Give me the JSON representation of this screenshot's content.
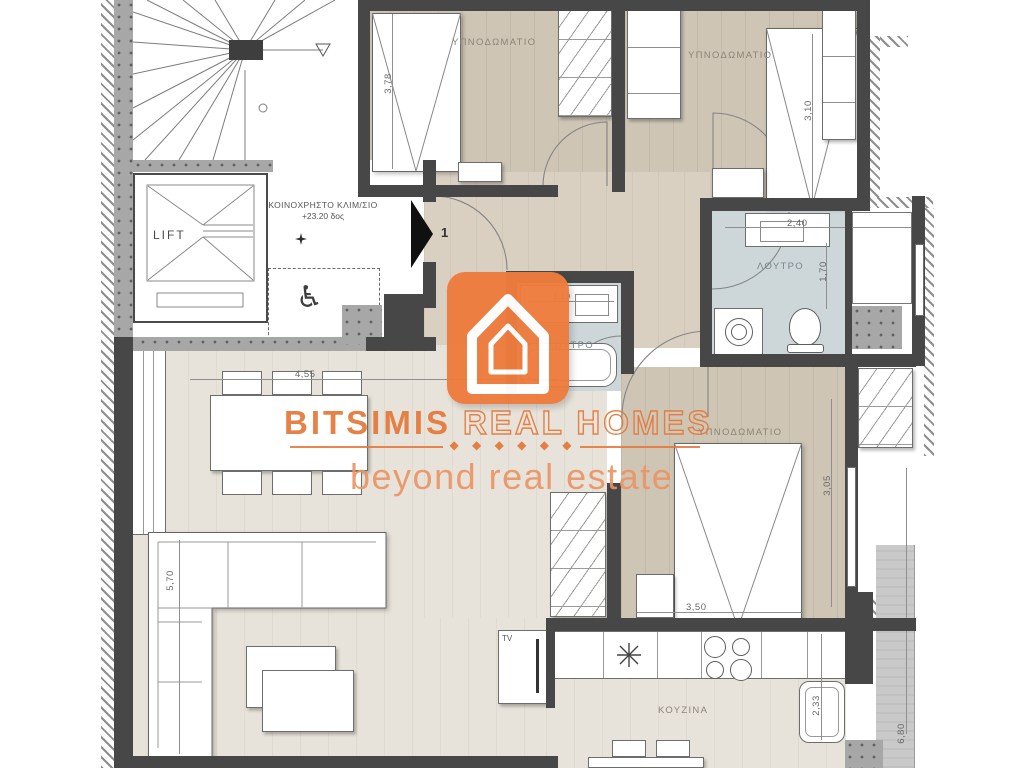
{
  "watermark": {
    "brand_primary": "BITSIMIS",
    "brand_secondary": "REAL HOMES",
    "tagline": "beyond real estate",
    "diamonds": "◆ ◆ ◆ ◆ ◆ ◆",
    "accent_color": "#e4793b"
  },
  "rooms": {
    "bedroom_top_left": "ΥΠΝΟΔΩΜΑΤΙΟ",
    "bedroom_top_right": "ΥΠΝΟΔΩΜΑΤΙΟ",
    "bedroom_right": "ΥΠΝΟΔΩΜΑΤΙΟ",
    "bathroom": "ΛΟΥΤΡΟ",
    "wc": "ΛΟΥΤΡΟ",
    "kitchen": "ΚΟΥΖΙΝΑ",
    "lift": "LIFT",
    "tv": "TV"
  },
  "common_area": {
    "label_line1": "ΚΟΙΝΟΧΡΗΣΤΟ ΚΛΙΜ/ΣΙΟ",
    "label_line2": "+23.20 δος",
    "entrance_number": "1"
  },
  "dimensions": {
    "bedroom1_width": "3,78",
    "bedroom2_width": "3,10",
    "bathroom_width": "2,40",
    "bathroom_depth": "1,70",
    "wc_width": "1,10",
    "living_width": "4,55",
    "sofa_length": "5,70",
    "bedroom3_width": "3,50",
    "bedroom3_depth": "3,05",
    "kitchen_depth": "2,33",
    "balcony_length": "6,80"
  },
  "colors": {
    "accent": "#ee7c3e",
    "wall_dark": "#474747",
    "wall_concrete": "#a7a7a7",
    "floor_bedroom": "#cec5b5",
    "floor_living": "#e8e3da",
    "floor_bath": "#cdd7da",
    "balcony": "#c9c9c9"
  }
}
